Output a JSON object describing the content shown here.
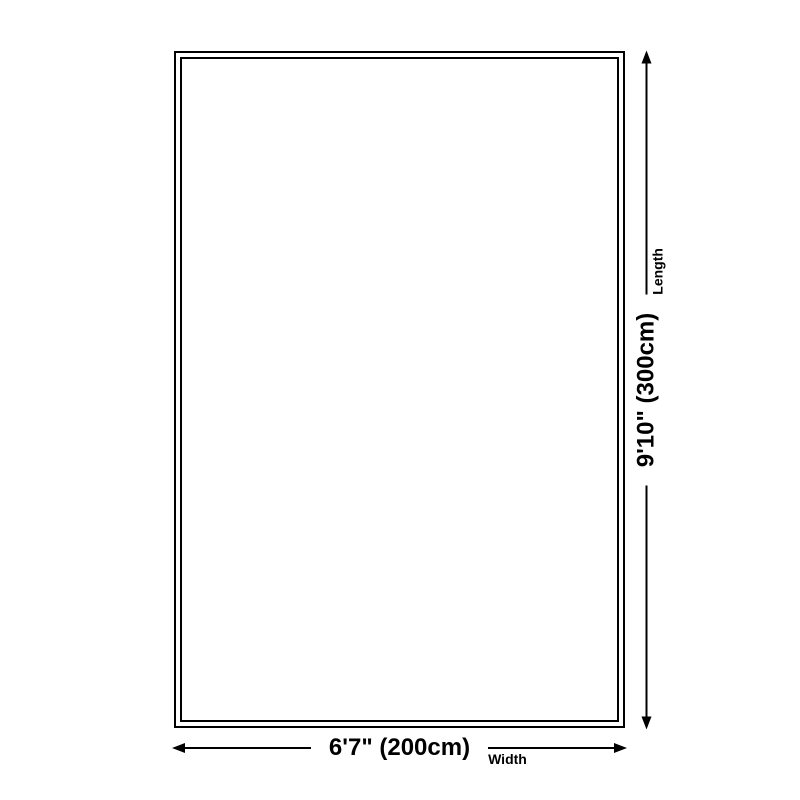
{
  "page": {
    "background_color": "#ffffff",
    "line_color": "#000000",
    "text_color": "#000000"
  },
  "diagram": {
    "kind": "rug-size-dimension-diagram",
    "rug": {
      "border_style": "double-black-outline",
      "fill": "#ffffff"
    },
    "dimensions": {
      "width": {
        "value": "6'7\" (200cm)",
        "label": "Width"
      },
      "length": {
        "value": "9'10\" (300cm)",
        "label": "Length"
      }
    }
  }
}
